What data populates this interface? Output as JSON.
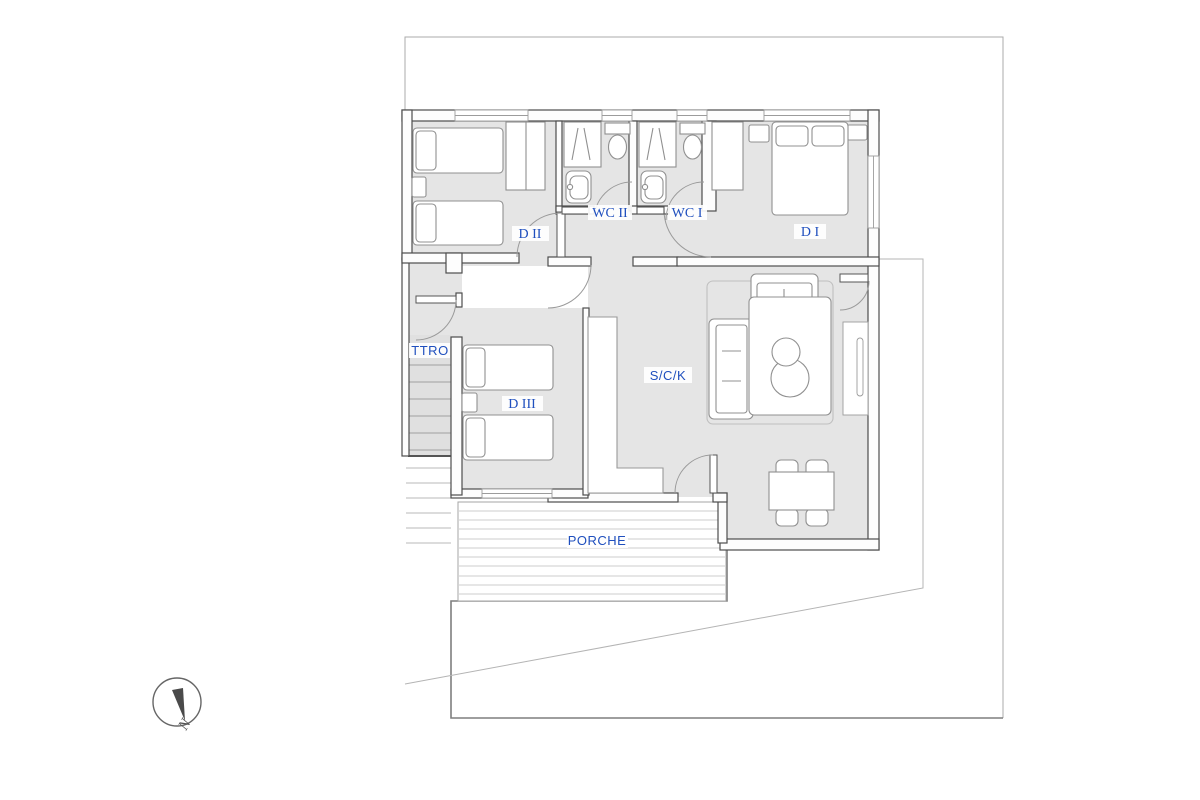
{
  "drawing": {
    "rooms": [
      {
        "id": "d2",
        "label": "D II"
      },
      {
        "id": "wc2",
        "label": "WC II"
      },
      {
        "id": "wc1",
        "label": "WC I"
      },
      {
        "id": "d1",
        "label": "D I"
      },
      {
        "id": "ttro",
        "label": "TTRO"
      },
      {
        "id": "d3",
        "label": "D III"
      },
      {
        "id": "sck",
        "label": "S/C/K"
      },
      {
        "id": "porche",
        "label": "PORCHE"
      }
    ],
    "compass": {
      "label": "N"
    },
    "colors": {
      "label_blue": "#1f4fbe",
      "wall": "#4d4d4d",
      "floor": "#e5e5e5",
      "boundary_light": "#ababab",
      "boundary_dark": "#7f7f7f",
      "furniture_stroke": "#909090"
    }
  }
}
